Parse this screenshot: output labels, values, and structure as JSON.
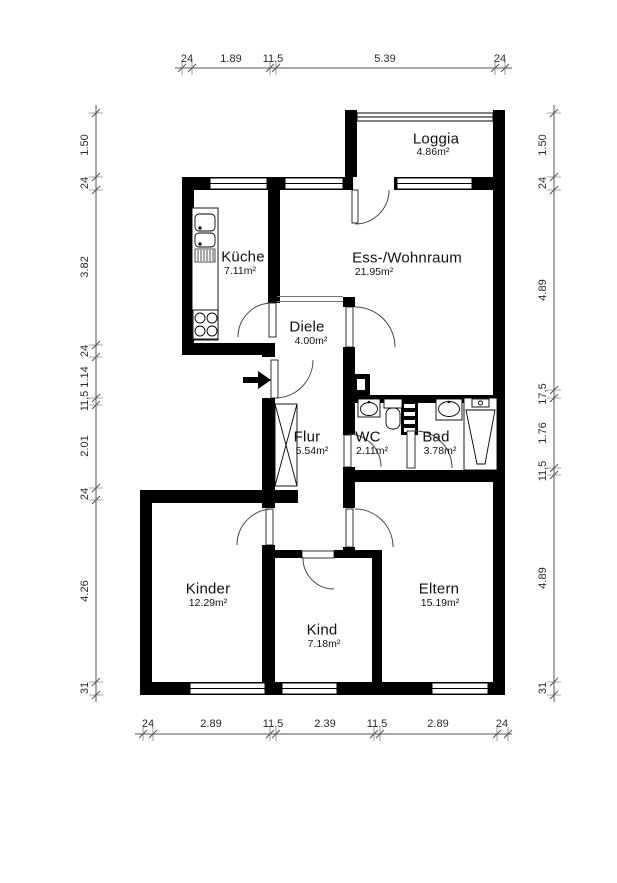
{
  "plan": {
    "type": "floorplan",
    "rooms": [
      {
        "name": "Loggia",
        "area": "4.86m²"
      },
      {
        "name": "Küche",
        "area": "7.11m²"
      },
      {
        "name": "Ess-/Wohnraum",
        "area": "21.95m²"
      },
      {
        "name": "Diele",
        "area": "4.00m²"
      },
      {
        "name": "Flur",
        "area": "5.54m²"
      },
      {
        "name": "WC",
        "area": "2.11m²"
      },
      {
        "name": "Bad",
        "area": "3.78m²"
      },
      {
        "name": "Kinder",
        "area": "12.29m²"
      },
      {
        "name": "Kind",
        "area": "7.18m²"
      },
      {
        "name": "Eltern",
        "area": "15.19m²"
      }
    ],
    "dimensions": {
      "top": [
        "24",
        "1.89",
        "11.5",
        "5.39",
        "24"
      ],
      "bottom": [
        "24",
        "2.89",
        "11.5",
        "2.39",
        "11.5",
        "2.89",
        "24"
      ],
      "left": [
        "1.50",
        "24",
        "3.82",
        "24",
        "1.14",
        "11,5",
        "2.01",
        "24",
        "4.26",
        "31"
      ],
      "right": [
        "1.50",
        "24",
        "4.89",
        "17,5",
        "1.76",
        "11,5",
        "4.89",
        "31"
      ]
    },
    "colors": {
      "wall": "#000000",
      "background": "#ffffff",
      "thin_line": "#555555"
    }
  }
}
